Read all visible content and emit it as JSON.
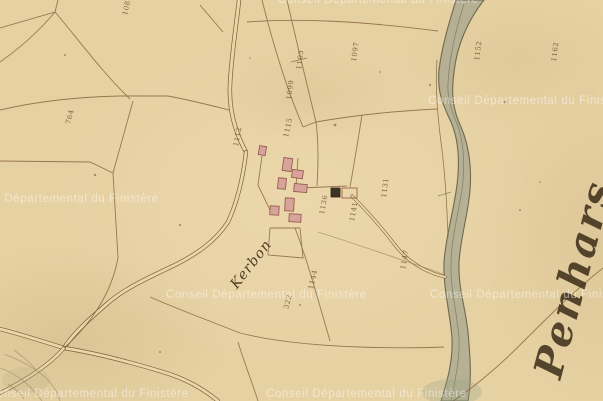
{
  "map": {
    "type": "historical-cadastral-map-tile",
    "hamlet_label": "Kerbon",
    "commune_label": "Penhars",
    "watermark_text": "Conseil Départemental du Finistère",
    "parcel_numbers": [
      {
        "label": "1086"
      },
      {
        "label": "764"
      },
      {
        "label": "1103"
      },
      {
        "label": "1099"
      },
      {
        "label": "1097"
      },
      {
        "label": "1152"
      },
      {
        "label": "1162"
      },
      {
        "label": "1112"
      },
      {
        "label": "1115"
      },
      {
        "label": "1131"
      },
      {
        "label": "1136"
      },
      {
        "label": "1141"
      },
      {
        "label": "1144"
      },
      {
        "label": "1147"
      },
      {
        "label": "322"
      }
    ],
    "features": {
      "river": "river running top to bottom on right side",
      "village": "hamlet building cluster left of center",
      "roads": "double-line roads from top edge, to southwest, and crossing in bottom-left corner"
    },
    "colors": {
      "paper": "#e6d1a3",
      "ink": "#7d5f38",
      "river_fill": "#adaa92",
      "river_stroke": "#6e6a50",
      "building_fill": "#d8a39b",
      "building_stroke": "#8f5448",
      "dark_building": "#3d3226",
      "watermark": "rgba(255,255,255,0.40)"
    }
  }
}
